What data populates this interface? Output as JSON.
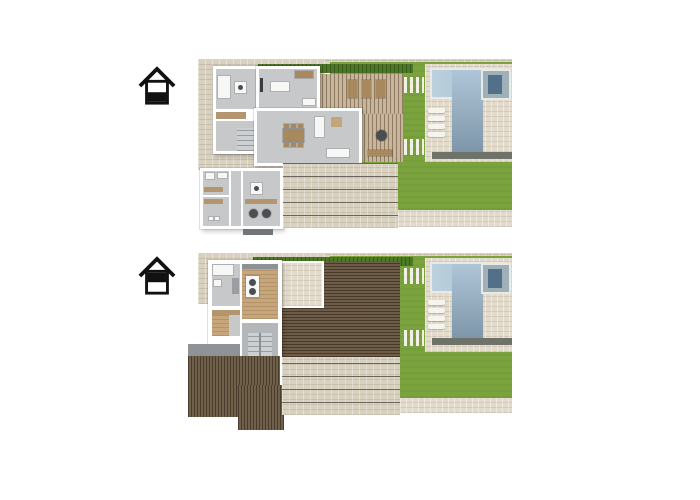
{
  "app": {
    "background": "#ffffff"
  },
  "palette": {
    "bg": "#ffffff",
    "lawn": "#7aa33e",
    "hedge": "#4d7826",
    "tile": "#d9d1c0",
    "tile_light": "#e2dbcb",
    "deck": "#c8b69c",
    "roof": "#6d5c47",
    "roof2": "#70604a",
    "pool_light": "#aec6d7",
    "pool_deep": "#7e96a9",
    "spa": "#527089",
    "spa_frame": "#9fb0b8",
    "floor": "#c6c8ca",
    "wood": "#c7a67c",
    "step_line": "#6b675c",
    "shadow_band": "#6e7268",
    "icon": "#111111"
  },
  "floors": [
    {
      "name": "ground-floor",
      "icon": "house-ground-floor-icon",
      "filled_part": "bottom"
    },
    {
      "name": "upper-floor",
      "icon": "house-upper-floor-icon",
      "filled_part": "top"
    }
  ]
}
